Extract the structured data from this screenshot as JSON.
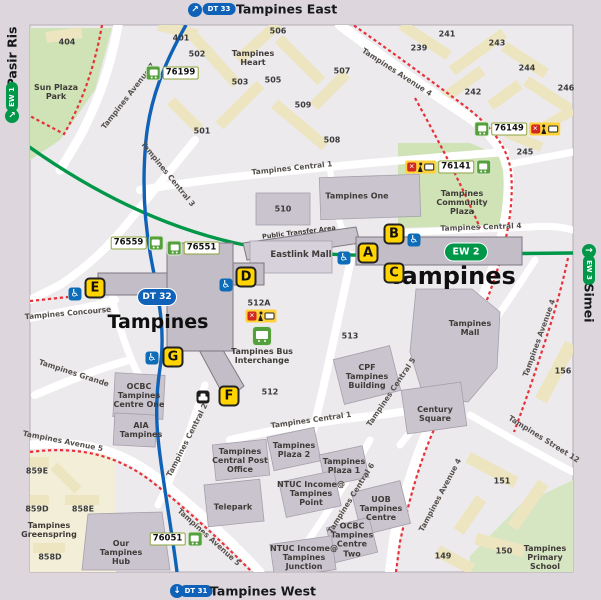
{
  "title": "Tampines MRT station locality map",
  "edges": {
    "top": {
      "badge": "DT 33",
      "label": "Tampines East"
    },
    "bottom": {
      "badge": "DT 31",
      "label": "Tampines West"
    },
    "left": {
      "badge": "EW 1",
      "label": "Pasir Ris"
    },
    "right": {
      "badge": "EW 3",
      "label": "Simei"
    }
  },
  "icons": {
    "arrow_up_right": "↗",
    "arrow_down": "↓",
    "arrow_right": "→",
    "wheelchair": "♿",
    "cross": "✕"
  },
  "stations": {
    "dt": {
      "badge": "DT 32",
      "name": "Tampines"
    },
    "ew": {
      "badge": "EW 2",
      "name": "Tampines"
    }
  },
  "exits": [
    "A",
    "B",
    "C",
    "D",
    "E",
    "F",
    "G"
  ],
  "bus_stops": [
    "76199",
    "76559",
    "76551",
    "76149",
    "76141",
    "76051"
  ],
  "roads": [
    "Tampines Avenue 7",
    "Tampines Avenue 4",
    "Tampines Central 3",
    "Tampines Central 1",
    "Tampines Central 4",
    "Tampines Central 5",
    "Tampines Central 1",
    "Tampines Central 2",
    "Tampines Central 6",
    "Tampines Concourse",
    "Tampines Grande",
    "Tampines Avenue 5",
    "Tampines Avenue 5",
    "Tampines Avenue 4",
    "Tampines Street 12",
    "Tampines Avenue 4"
  ],
  "places": [
    "Sun Plaza Park",
    "Tampines Heart",
    "Tampines Community Plaza",
    "Tampines One",
    "Eastlink Mall",
    "Public Transfer Area",
    "Tampines Mall",
    "Century Square",
    "CPF Tampines Building",
    "Tampines Bus Interchange",
    "Telepark",
    "Tampines Central Post Office",
    "Tampines Plaza 2",
    "Tampines Plaza 1",
    "NTUC Income@ Tampines Point",
    "UOB Tampines Centre",
    "OCBC Tampines Centre Two",
    "NTUC Income@ Tampines Junction",
    "OCBC Tampines Centre One",
    "AIA Tampines",
    "Our Tampines Hub",
    "Tampines Greenspring",
    "Tampines Primary School"
  ],
  "blocks": [
    "404",
    "401",
    "502",
    "506",
    "503",
    "505",
    "501",
    "509",
    "508",
    "507",
    "239",
    "241",
    "243",
    "244",
    "242",
    "246",
    "245",
    "510",
    "512",
    "512A",
    "513",
    "156",
    "151",
    "150",
    "149",
    "859E",
    "859D",
    "858E",
    "858D"
  ],
  "colors": {
    "dt_line_blue": "#0f62b7",
    "ew_line_green": "#009749",
    "exit_yellow": "#ffd400",
    "bus_icon_green": "#55a03c",
    "alert_badge_yellow": "#ffd23a",
    "cycling_path_red": "#e63138",
    "park_green": "#cfe3b6",
    "building_grey": "#cac4ce",
    "hdb_yellow": "#ece5c0"
  }
}
